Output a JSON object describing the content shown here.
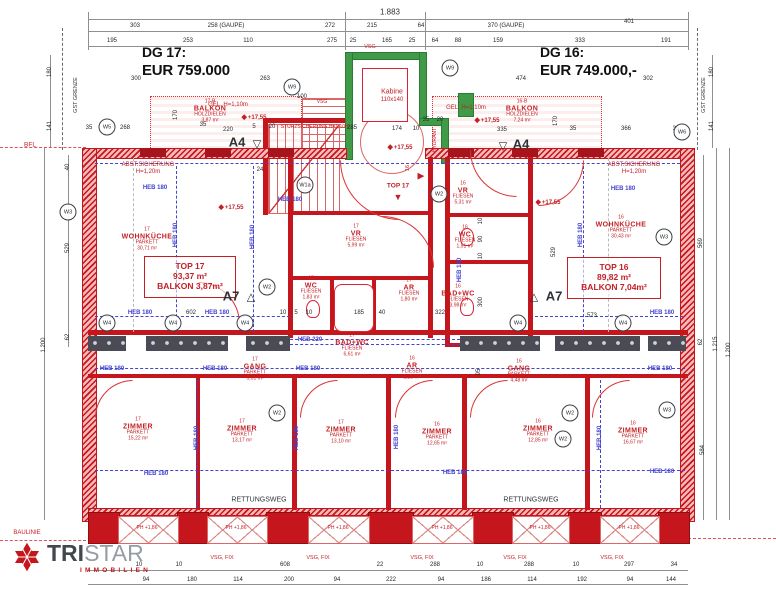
{
  "colors": {
    "wall_red": "#c4161c",
    "green": "#3f9b48",
    "beam_blue": "#4343cf",
    "text_red": "#c32026",
    "dark": "#2e3338",
    "logo_dark": "#43484e",
    "logo_gray": "#969ca3"
  },
  "titles": {
    "left_label": "DG 17:",
    "left_price": "EUR 759.000",
    "right_label": "DG 16:",
    "right_price": "EUR 749.000,-"
  },
  "logo": {
    "bold": "TRI",
    "light": "STAR",
    "sub": "IMMOBILIEN",
    "star_icon": "tristar-star-icon"
  },
  "boxes": {
    "t17": [
      "TOP 17",
      "93,37 m²",
      "BALKON 3,87m²"
    ],
    "t16": [
      "TOP 16",
      "89,82 m²",
      "BALKON 7,04m²"
    ]
  },
  "rooms": [
    {
      "nr": "17",
      "name": "WOHNKÜCHE",
      "floor": "PARKETT",
      "area": "30,71 m²",
      "x": 147,
      "y": 240
    },
    {
      "nr": "16",
      "name": "WOHNKÜCHE",
      "floor": "PARKETT",
      "area": "30,43 m²",
      "x": 621,
      "y": 228
    },
    {
      "nr": "17",
      "name": "VR",
      "floor": "FLIESEN",
      "area": "5,99 m²",
      "x": 356,
      "y": 237
    },
    {
      "nr": "17",
      "name": "WC",
      "floor": "FLIESEN",
      "area": "1,83 m²",
      "x": 311,
      "y": 289
    },
    {
      "nr": "17",
      "name": "BAD+WC",
      "floor": "FLIESEN",
      "area": "6,61 m²",
      "x": 352,
      "y": 346
    },
    {
      "nr": "17",
      "name": "AR",
      "floor": "FLIESEN",
      "area": "1,80 m²",
      "x": 409,
      "y": 291
    },
    {
      "nr": "16",
      "name": "VR",
      "floor": "FLIESEN",
      "area": "5,31 m²",
      "x": 463,
      "y": 194
    },
    {
      "nr": "16",
      "name": "WC",
      "floor": "FLIESEN",
      "area": "1,51 m²",
      "x": 465,
      "y": 238
    },
    {
      "nr": "16",
      "name": "BAD+WC",
      "floor": "FLIESEN",
      "area": "3,98 m²",
      "x": 458,
      "y": 297
    },
    {
      "nr": "16",
      "name": "AR",
      "floor": "FLIESEN",
      "area": "2,28 m²",
      "x": 412,
      "y": 369
    },
    {
      "nr": "17",
      "name": "GANG",
      "floor": "PARKETT",
      "area": "5,01 m²",
      "x": 255,
      "y": 370
    },
    {
      "nr": "16",
      "name": "GANG",
      "floor": "PARKETT",
      "area": "4,48 m²",
      "x": 519,
      "y": 372
    },
    {
      "nr": "17",
      "name": "ZIMMER",
      "floor": "PARKETT",
      "area": "15,22 m²",
      "x": 138,
      "y": 430
    },
    {
      "nr": "17",
      "name": "ZIMMER",
      "floor": "PARKETT",
      "area": "13,17 m²",
      "x": 242,
      "y": 432
    },
    {
      "nr": "17",
      "name": "ZIMMER",
      "floor": "PARKETT",
      "area": "13,10 m²",
      "x": 341,
      "y": 433
    },
    {
      "nr": "16",
      "name": "ZIMMER",
      "floor": "PARKETT",
      "area": "12,65 m²",
      "x": 437,
      "y": 435
    },
    {
      "nr": "16",
      "name": "ZIMMER",
      "floor": "PARKETT",
      "area": "12,85 m²",
      "x": 538,
      "y": 432
    },
    {
      "nr": "16",
      "name": "ZIMMER",
      "floor": "PARKETT",
      "area": "16,67 m²",
      "x": 633,
      "y": 434
    },
    {
      "nr": "17-B",
      "name": "BALKON",
      "floor": "HOLZDIELEN",
      "area": "3,87 m²",
      "x": 210,
      "y": 112
    },
    {
      "nr": "16-B",
      "name": "BALKON",
      "floor": "HOLZDIELEN",
      "area": "7,24 m²",
      "x": 522,
      "y": 112
    }
  ],
  "elevations": [
    {
      "t": "+17,55",
      "x": 231,
      "y": 207
    },
    {
      "t": "+17,55",
      "x": 548,
      "y": 202
    },
    {
      "t": "+17,55",
      "x": 400,
      "y": 147
    },
    {
      "t": "+17,55",
      "x": 254,
      "y": 117
    },
    {
      "t": "+17,55",
      "x": 487,
      "y": 120
    }
  ],
  "wcircles": [
    {
      "t": "W5",
      "x": 107,
      "y": 127
    },
    {
      "t": "W9",
      "x": 292,
      "y": 87
    },
    {
      "t": "W9",
      "x": 450,
      "y": 68
    },
    {
      "t": "W6",
      "x": 682,
      "y": 132
    },
    {
      "t": "W3",
      "x": 68,
      "y": 212
    },
    {
      "t": "W1a",
      "x": 305,
      "y": 185
    },
    {
      "t": "W2",
      "x": 439,
      "y": 194
    },
    {
      "t": "W2",
      "x": 267,
      "y": 287
    },
    {
      "t": "W4",
      "x": 107,
      "y": 323
    },
    {
      "t": "W4",
      "x": 173,
      "y": 323
    },
    {
      "t": "W4",
      "x": 245,
      "y": 323
    },
    {
      "t": "W4",
      "x": 518,
      "y": 323
    },
    {
      "t": "W4",
      "x": 623,
      "y": 323
    },
    {
      "t": "W2",
      "x": 277,
      "y": 413
    },
    {
      "t": "W2",
      "x": 570,
      "y": 413
    },
    {
      "t": "W2",
      "x": 563,
      "y": 439
    },
    {
      "t": "W3",
      "x": 667,
      "y": 410
    },
    {
      "t": "W3",
      "x": 664,
      "y": 237
    }
  ],
  "heb": [
    {
      "t": "HEB 180",
      "x": 155,
      "y": 188
    },
    {
      "t": "HEB 180",
      "x": 623,
      "y": 189
    },
    {
      "t": "HEB 180",
      "x": 290,
      "y": 200
    },
    {
      "t": "HEB 180",
      "x": 140,
      "y": 313
    },
    {
      "t": "HEB 180",
      "x": 217,
      "y": 313
    },
    {
      "t": "HEB 180",
      "x": 662,
      "y": 313
    },
    {
      "t": "HEB 220",
      "x": 310,
      "y": 340
    },
    {
      "t": "HEB 180",
      "x": 112,
      "y": 369
    },
    {
      "t": "HEB 180",
      "x": 215,
      "y": 369
    },
    {
      "t": "HEB 180",
      "x": 308,
      "y": 369
    },
    {
      "t": "HEB 180",
      "x": 660,
      "y": 369
    },
    {
      "t": "HEB 180",
      "x": 156,
      "y": 474
    },
    {
      "t": "HEB 180",
      "x": 455,
      "y": 473
    },
    {
      "t": "HEB 180",
      "x": 662,
      "y": 472
    },
    {
      "t": "HEB 180",
      "x": 176,
      "y": 235,
      "r": 1
    },
    {
      "t": "HEB 180",
      "x": 253,
      "y": 237,
      "r": 1
    },
    {
      "t": "HEB 180",
      "x": 581,
      "y": 235,
      "r": 1
    },
    {
      "t": "HEB 180",
      "x": 460,
      "y": 270,
      "r": 1
    },
    {
      "t": "HEB 180",
      "x": 197,
      "y": 438,
      "r": 1
    },
    {
      "t": "HEB 180",
      "x": 297,
      "y": 438,
      "r": 1
    },
    {
      "t": "HEB 180",
      "x": 397,
      "y": 437,
      "r": 1
    },
    {
      "t": "HEB 180",
      "x": 600,
      "y": 438,
      "r": 1
    }
  ],
  "labels": [
    {
      "t": "1.883",
      "x": 390,
      "y": 12,
      "c": "d",
      "s": 8
    },
    {
      "t": "ABST.SICHERUNG",
      "x": 148,
      "y": 165,
      "c": "r",
      "s": 6
    },
    {
      "t": "H=1,20m",
      "x": 148,
      "y": 172,
      "c": "r",
      "s": 6
    },
    {
      "t": "ABST.SICHERUNG",
      "x": 634,
      "y": 165,
      "c": "r",
      "s": 6
    },
    {
      "t": "H=1,20m",
      "x": 634,
      "y": 172,
      "c": "r",
      "s": 6
    },
    {
      "t": "STURZSICHERUNG H=1,10m",
      "x": 315,
      "y": 127,
      "c": "r",
      "s": 5
    },
    {
      "t": "GEL. H=1,10m",
      "x": 228,
      "y": 105,
      "c": "r",
      "s": 6
    },
    {
      "t": "GEL. H=1,10m",
      "x": 466,
      "y": 108,
      "c": "r",
      "s": 6
    },
    {
      "t": "Kabine",
      "x": 392,
      "y": 92,
      "c": "r",
      "s": 7
    },
    {
      "t": "110x140",
      "x": 392,
      "y": 100,
      "c": "r",
      "s": 6
    },
    {
      "t": "HYDRANT",
      "x": 435,
      "y": 140,
      "c": "r",
      "s": 5,
      "r": 1
    },
    {
      "t": "VSG",
      "x": 370,
      "y": 47,
      "c": "r",
      "s": 5.5
    },
    {
      "t": "VSG",
      "x": 322,
      "y": 102,
      "c": "r",
      "s": 5
    },
    {
      "t": "TOP 17",
      "x": 398,
      "y": 186,
      "c": "r",
      "s": 6.5,
      "b": 1
    },
    {
      "t": "▼",
      "x": 398,
      "y": 197,
      "c": "r",
      "s": 9
    },
    {
      "t": "▶",
      "x": 421,
      "y": 176,
      "c": "r",
      "s": 9
    },
    {
      "t": "16",
      "x": 408,
      "y": 168,
      "c": "r",
      "s": 5.5,
      "r": 1
    },
    {
      "t": "RETTUNGSWEG",
      "x": 259,
      "y": 500,
      "c": "d",
      "s": 7
    },
    {
      "t": "RETTUNGSWEG",
      "x": 531,
      "y": 500,
      "c": "d",
      "s": 7
    },
    {
      "t": "VSG, FIX",
      "x": 222,
      "y": 558,
      "c": "r",
      "s": 5.5
    },
    {
      "t": "VSG, FIX",
      "x": 318,
      "y": 558,
      "c": "r",
      "s": 5.5
    },
    {
      "t": "VSG, FIX",
      "x": 422,
      "y": 558,
      "c": "r",
      "s": 5.5
    },
    {
      "t": "VSG, FIX",
      "x": 515,
      "y": 558,
      "c": "r",
      "s": 5.5
    },
    {
      "t": "VSG, FIX",
      "x": 612,
      "y": 558,
      "c": "r",
      "s": 5.5
    },
    {
      "t": "PH +1,86",
      "x": 147,
      "y": 528,
      "c": "r",
      "s": 5
    },
    {
      "t": "PH +1,86",
      "x": 236,
      "y": 528,
      "c": "r",
      "s": 5
    },
    {
      "t": "PH +1,86",
      "x": 338,
      "y": 528,
      "c": "r",
      "s": 5
    },
    {
      "t": "PH +1,86",
      "x": 442,
      "y": 528,
      "c": "r",
      "s": 5
    },
    {
      "t": "PH +1,86",
      "x": 540,
      "y": 528,
      "c": "r",
      "s": 5
    },
    {
      "t": "PH +1,86",
      "x": 629,
      "y": 528,
      "c": "r",
      "s": 5
    },
    {
      "t": "BAULINIE",
      "x": 27,
      "y": 533,
      "c": "r",
      "s": 6
    },
    {
      "t": "BFL",
      "x": 30,
      "y": 145,
      "c": "r",
      "s": 6.5
    },
    {
      "t": "GST GRENZE",
      "x": 76,
      "y": 95,
      "c": "d",
      "s": 5.5,
      "r": 1
    },
    {
      "t": "GST GRENZE",
      "x": 704,
      "y": 95,
      "c": "d",
      "s": 5.5,
      "r": 1
    },
    {
      "t": "A4",
      "x": 237,
      "y": 142,
      "c": "d",
      "s": 13,
      "b": 1
    },
    {
      "t": "▽",
      "x": 257,
      "y": 144,
      "c": "d",
      "s": 11
    },
    {
      "t": "▽",
      "x": 503,
      "y": 146,
      "c": "d",
      "s": 11
    },
    {
      "t": "A4",
      "x": 521,
      "y": 144,
      "c": "d",
      "s": 13,
      "b": 1
    },
    {
      "t": "A7",
      "x": 231,
      "y": 296,
      "c": "d",
      "s": 13,
      "b": 1
    },
    {
      "t": "△",
      "x": 251,
      "y": 297,
      "c": "d",
      "s": 11
    },
    {
      "t": "△",
      "x": 534,
      "y": 297,
      "c": "d",
      "s": 11
    },
    {
      "t": "A7",
      "x": 554,
      "y": 296,
      "c": "d",
      "s": 13,
      "b": 1
    }
  ],
  "dims": [
    {
      "t": "303",
      "x": 135,
      "y": 26
    },
    {
      "t": "258 (GAUPE)",
      "x": 226,
      "y": 26
    },
    {
      "t": "272",
      "x": 330,
      "y": 26
    },
    {
      "t": "215",
      "x": 372,
      "y": 26
    },
    {
      "t": "64",
      "x": 421,
      "y": 26
    },
    {
      "t": "370 (GAUPE)",
      "x": 506,
      "y": 26
    },
    {
      "t": "401",
      "x": 629,
      "y": 22
    },
    {
      "t": "195",
      "x": 112,
      "y": 41
    },
    {
      "t": "253",
      "x": 188,
      "y": 41
    },
    {
      "t": "110",
      "x": 248,
      "y": 41
    },
    {
      "t": "275",
      "x": 332,
      "y": 41
    },
    {
      "t": "25",
      "x": 353,
      "y": 41
    },
    {
      "t": "165",
      "x": 387,
      "y": 41
    },
    {
      "t": "25",
      "x": 412,
      "y": 41
    },
    {
      "t": "64",
      "x": 435,
      "y": 41
    },
    {
      "t": "88",
      "x": 458,
      "y": 41
    },
    {
      "t": "159",
      "x": 498,
      "y": 41
    },
    {
      "t": "333",
      "x": 580,
      "y": 41
    },
    {
      "t": "191",
      "x": 666,
      "y": 41
    },
    {
      "t": "300",
      "x": 136,
      "y": 79
    },
    {
      "t": "263",
      "x": 265,
      "y": 79
    },
    {
      "t": "474",
      "x": 521,
      "y": 79
    },
    {
      "t": "302",
      "x": 648,
      "y": 79
    },
    {
      "t": "100",
      "x": 302,
      "y": 97
    },
    {
      "t": "35",
      "x": 89,
      "y": 128
    },
    {
      "t": "268",
      "x": 125,
      "y": 128
    },
    {
      "t": "170",
      "x": 176,
      "y": 115,
      "r": 1
    },
    {
      "t": "35",
      "x": 203,
      "y": 125
    },
    {
      "t": "220",
      "x": 228,
      "y": 130
    },
    {
      "t": "5",
      "x": 254,
      "y": 127
    },
    {
      "t": "20",
      "x": 272,
      "y": 127
    },
    {
      "t": "285",
      "x": 352,
      "y": 128
    },
    {
      "t": "174",
      "x": 397,
      "y": 129
    },
    {
      "t": "10",
      "x": 416,
      "y": 129
    },
    {
      "t": "35",
      "x": 426,
      "y": 120
    },
    {
      "t": "20",
      "x": 440,
      "y": 120
    },
    {
      "t": "335",
      "x": 502,
      "y": 130
    },
    {
      "t": "170",
      "x": 556,
      "y": 121,
      "r": 1
    },
    {
      "t": "35",
      "x": 573,
      "y": 129
    },
    {
      "t": "366",
      "x": 626,
      "y": 129
    },
    {
      "t": "35",
      "x": 676,
      "y": 129
    },
    {
      "t": "24",
      "x": 260,
      "y": 170
    },
    {
      "t": "602",
      "x": 191,
      "y": 313
    },
    {
      "t": "10",
      "x": 283,
      "y": 313
    },
    {
      "t": "5",
      "x": 296,
      "y": 313
    },
    {
      "t": "10",
      "x": 309,
      "y": 313
    },
    {
      "t": "185",
      "x": 359,
      "y": 313
    },
    {
      "t": "40",
      "x": 382,
      "y": 313
    },
    {
      "t": "322",
      "x": 440,
      "y": 313
    },
    {
      "t": "573",
      "x": 592,
      "y": 316
    },
    {
      "t": "95",
      "x": 479,
      "y": 372,
      "r": 1
    },
    {
      "t": "10",
      "x": 481,
      "y": 221,
      "r": 1
    },
    {
      "t": "90",
      "x": 481,
      "y": 239,
      "r": 1
    },
    {
      "t": "10",
      "x": 481,
      "y": 256,
      "r": 1
    },
    {
      "t": "300",
      "x": 481,
      "y": 302,
      "r": 1
    },
    {
      "t": "40",
      "x": 68,
      "y": 167,
      "r": 1
    },
    {
      "t": "529",
      "x": 68,
      "y": 248,
      "r": 1
    },
    {
      "t": "62",
      "x": 68,
      "y": 337,
      "r": 1
    },
    {
      "t": "1.200",
      "x": 44,
      "y": 345,
      "r": 1
    },
    {
      "t": "180",
      "x": 50,
      "y": 72,
      "r": 1
    },
    {
      "t": "141",
      "x": 50,
      "y": 126,
      "r": 1
    },
    {
      "t": "529",
      "x": 554,
      "y": 252,
      "r": 1
    },
    {
      "t": "569",
      "x": 701,
      "y": 243,
      "r": 1
    },
    {
      "t": "62",
      "x": 701,
      "y": 342,
      "r": 1
    },
    {
      "t": "584",
      "x": 703,
      "y": 450,
      "r": 1
    },
    {
      "t": "1.215",
      "x": 716,
      "y": 344,
      "r": 1
    },
    {
      "t": "1.200",
      "x": 729,
      "y": 350,
      "r": 1
    },
    {
      "t": "180",
      "x": 712,
      "y": 72,
      "r": 1
    },
    {
      "t": "141",
      "x": 712,
      "y": 126,
      "r": 1
    },
    {
      "t": "10",
      "x": 139,
      "y": 565
    },
    {
      "t": "10",
      "x": 179,
      "y": 565
    },
    {
      "t": "608",
      "x": 285,
      "y": 565
    },
    {
      "t": "22",
      "x": 380,
      "y": 565
    },
    {
      "t": "288",
      "x": 435,
      "y": 565
    },
    {
      "t": "10",
      "x": 480,
      "y": 565
    },
    {
      "t": "288",
      "x": 529,
      "y": 565
    },
    {
      "t": "10",
      "x": 576,
      "y": 565
    },
    {
      "t": "297",
      "x": 629,
      "y": 565
    },
    {
      "t": "34",
      "x": 674,
      "y": 565
    },
    {
      "t": "94",
      "x": 146,
      "y": 580
    },
    {
      "t": "180",
      "x": 192,
      "y": 580
    },
    {
      "t": "114",
      "x": 238,
      "y": 580
    },
    {
      "t": "200",
      "x": 289,
      "y": 580
    },
    {
      "t": "94",
      "x": 337,
      "y": 580
    },
    {
      "t": "222",
      "x": 391,
      "y": 580
    },
    {
      "t": "94",
      "x": 441,
      "y": 580
    },
    {
      "t": "186",
      "x": 486,
      "y": 580
    },
    {
      "t": "114",
      "x": 532,
      "y": 580
    },
    {
      "t": "192",
      "x": 582,
      "y": 580
    },
    {
      "t": "94",
      "x": 630,
      "y": 580
    },
    {
      "t": "144",
      "x": 671,
      "y": 580
    }
  ]
}
